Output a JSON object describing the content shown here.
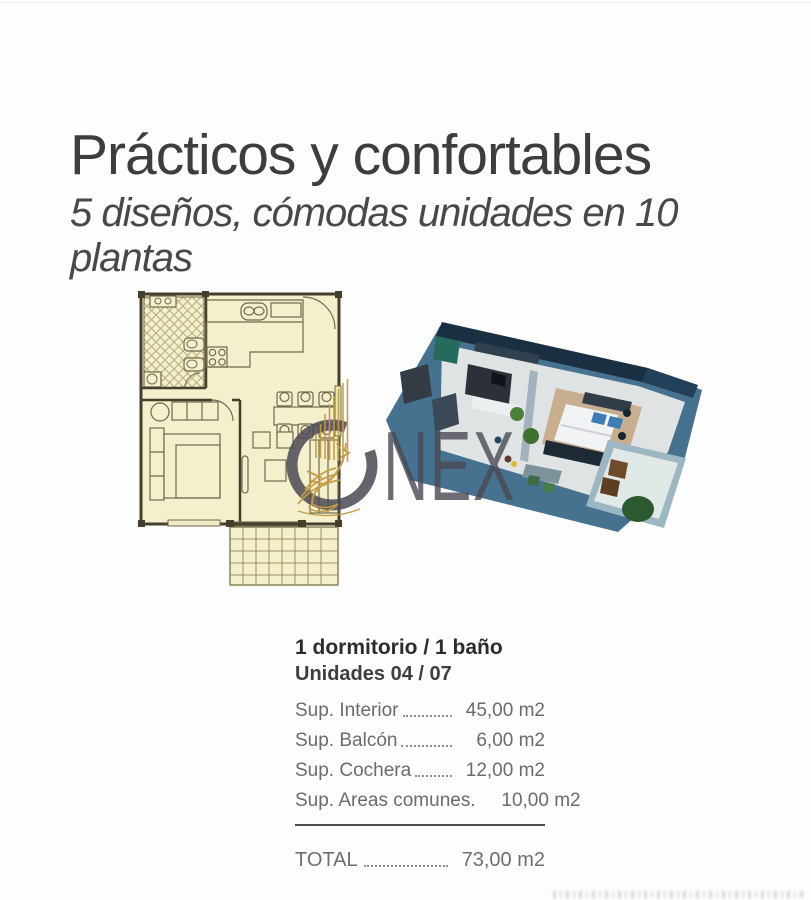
{
  "header": {
    "title": "Prácticos y confortables",
    "subtitle": "5 diseños, cómodas unidades en 10 plantas"
  },
  "watermark": {
    "letters": "NEX",
    "ring_color": "#4a4952",
    "griffin_color": "#c49a44"
  },
  "unit_card": {
    "title": "1 dormitorio / 1 baño",
    "units_line": "Unidades 04 / 07",
    "rows": [
      {
        "label": "Sup. Interior",
        "value": "45,00 m2"
      },
      {
        "label": "Sup. Balcón",
        "value": "6,00 m2"
      },
      {
        "label": "Sup. Cochera",
        "value": "12,00 m2"
      },
      {
        "label": "Sup. Areas comunes.",
        "value": "10,00 m2"
      }
    ],
    "total": {
      "label": "TOTAL",
      "value": "73,00 m2"
    }
  },
  "figures": {
    "floorplan_2d": {
      "fill": "#f4efcd",
      "wall_color": "#453f2b",
      "line_color": "#6f6950"
    },
    "render_3d": {
      "base_color": "#46728f",
      "floor_color": "#e0e3e3",
      "roof_color": "#1b2f42"
    }
  }
}
